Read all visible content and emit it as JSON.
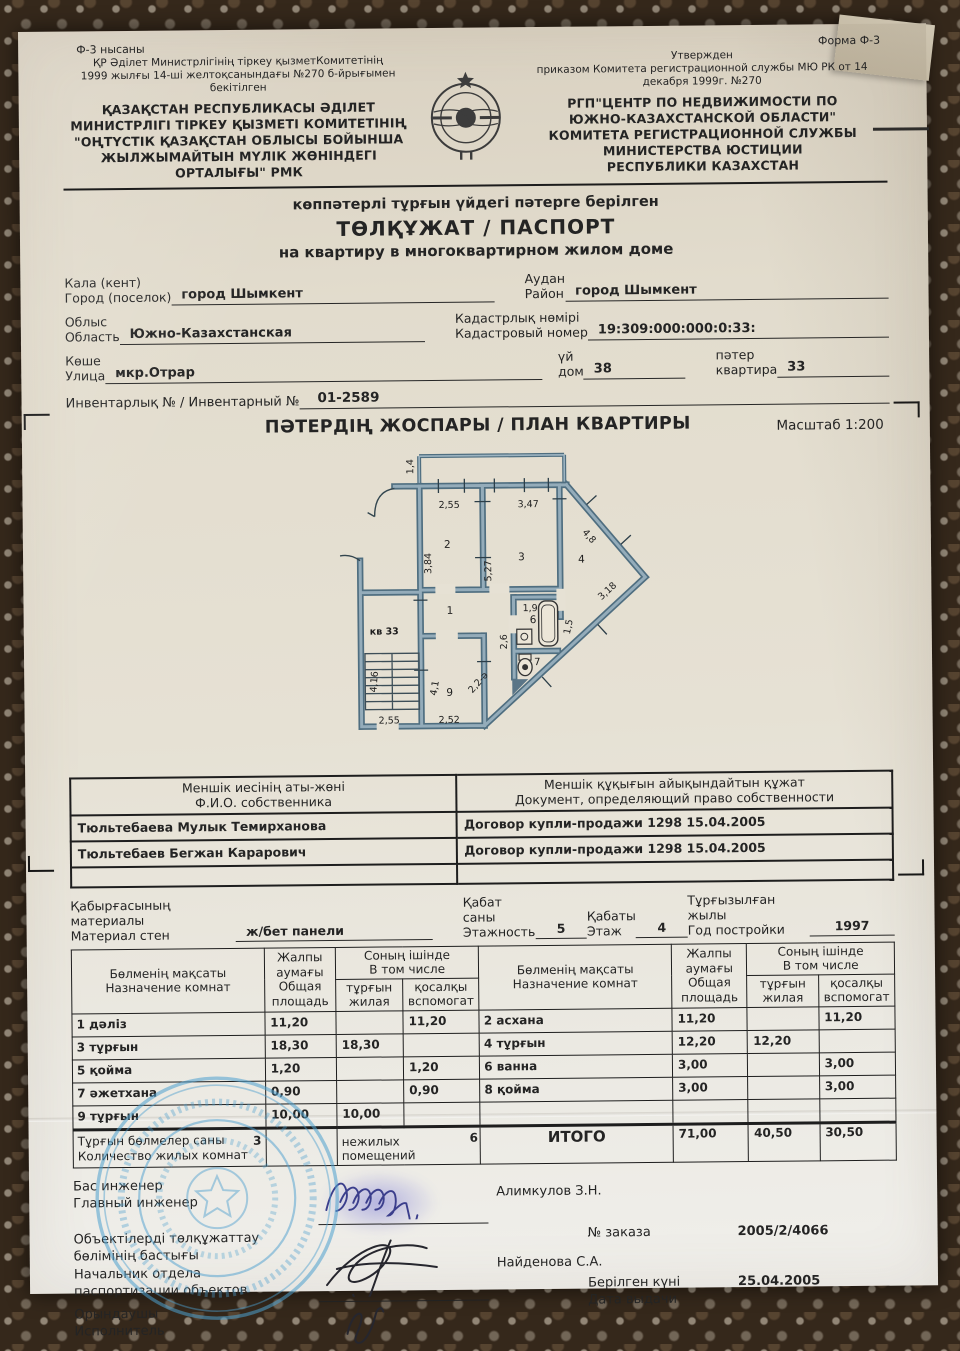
{
  "colors": {
    "paper": "#e6e1d4",
    "ink": "#242424",
    "wall_dark": "#4f6e80",
    "wall_light": "#94acba",
    "stamp_blue": "#4d9fce"
  },
  "header": {
    "form_kz": "Ф-3 нысаны",
    "form_ru": "Форма Ф-3",
    "approved_kz": [
      "ҚР Әділет Министрлігінің тіркеу қызметКомитетінің",
      "1999 жылғы 14-ші желтоқсанындағы №270 б-йрығымен",
      "бекітілген"
    ],
    "org_kz": [
      "ҚАЗАҚСТАН РЕСПУБЛИКАСЫ ӘДІЛЕТ",
      "МИНИСТРЛІГІ ТІРКЕУ ҚЫЗМЕТІ КОМИТЕТІНІҢ",
      "\"ОҢТҮСТІК ҚАЗАҚСТАН ОБЛЫСЫ БОЙЫНША",
      "ЖЫЛЖЫМАЙТЫН МҮЛІК ЖӨНІНДЕГІ",
      "ОРТАЛЫҒЫ\" РМК"
    ],
    "approved_ru": [
      "Утвержден",
      "приказом Комитета регистрационной службы МЮ РК от 14",
      "декабря 1999г.  №270"
    ],
    "org_ru": [
      "РГП\"ЦЕНТР ПО НЕДВИЖИМОСТИ ПО",
      "ЮЖНО-КАЗАХСТАНСКОЙ ОБЛАСТИ\"",
      "КОМИТЕТА РЕГИСТРАЦИОННОЙ СЛУЖБЫ",
      "МИНИСТЕРСТВА ЮСТИЦИИ",
      "РЕСПУБЛИКИ КАЗАХСТАН"
    ]
  },
  "title": {
    "line1": "көппәтерлі тұрғын үйдегі пәтерге берілген",
    "line2": "ТӨЛҚҰЖАТ / ПАСПОРТ",
    "line3": "на квартиру в многоквартирном жилом доме"
  },
  "fields": {
    "city_kz": "Кала (кент)",
    "city_ru": "Город (поселок)",
    "city_value": "город Шымкент",
    "district_kz": "Аудан",
    "district_ru": "Район",
    "district_value": "город Шымкент",
    "oblast_kz": "Облыс",
    "oblast_ru": "Область",
    "oblast_value": "Южно-Казахстанская",
    "cadastre_kz": "Кадастрлық нөмірі",
    "cadastre_ru": "Кадастровый номер",
    "cadastre_value": "19:309:000:000:0:33:",
    "street_kz": "Көше",
    "street_ru": "Улица",
    "street_value": "мкр.Отрар",
    "house_kz": "үй",
    "house_ru": "дом",
    "house_value": "38",
    "apt_kz": "пәтер",
    "apt_ru": "квартира",
    "apt_value": "33",
    "inventory_label": "Инвентарлық № / Инвентарный №",
    "inventory_value": "01-2589"
  },
  "plan": {
    "heading": "ПӘТЕРДІҢ ЖОСПАРЫ / ПЛАН КВАРТИРЫ",
    "scale": "Масштаб 1:200",
    "dims": [
      "1,4",
      "2,55",
      "3,47",
      "2",
      "3",
      "3,84",
      "5,27",
      "4,8",
      "4",
      "3,18",
      "1",
      "кв 33",
      "1,9",
      "6",
      "1,5",
      "2,6",
      "7",
      "4,16",
      "4,1",
      "9",
      "2,2-ә",
      "2,55",
      "2,52"
    ]
  },
  "owners": {
    "col1": [
      "Меншік иесінің аты-жөні",
      "Ф.И.О. собственника"
    ],
    "col2": [
      "Меншік құқығын айықындайтын құжат",
      "Документ, определяющий право собственности"
    ],
    "rows": [
      {
        "name": "Тюльтебаева Мулык Темирханова",
        "doc": "Договор купли-продажи 1298 15.04.2005"
      },
      {
        "name": "Тюльтебаев Бегжан Карарович",
        "doc": "Договор купли-продажи 1298 15.04.2005"
      }
    ]
  },
  "building": {
    "material_kz": "Қабырғасының материалы",
    "material_ru": "Материал стен",
    "material_value": "ж/бет панели",
    "floors_kz": "Қабат саны",
    "floors_ru": "Этажность",
    "floors_value": "5",
    "floor_kz": "Қабаты",
    "floor_ru": "Этаж",
    "floor_value": "4",
    "year_kz": "Тұрғызылған жылы",
    "year_ru": "Год постройки",
    "year_value": "1997"
  },
  "rooms": {
    "purpose": [
      "Бөлменің мақсаты",
      "Назначение комнат"
    ],
    "total": [
      "Жалпы",
      "аумағы",
      "Общая",
      "площадь"
    ],
    "incl": [
      "Соның ішінде",
      "В том числе"
    ],
    "living": [
      "тұрғын",
      "жилая"
    ],
    "aux": [
      "қосалқы",
      "вспомогат"
    ],
    "left_rows": [
      [
        "1 дәліз",
        "11,20",
        "",
        "11,20"
      ],
      [
        "3 тұрғын",
        "18,30",
        "18,30",
        ""
      ],
      [
        "5 қойма",
        "1,20",
        "",
        "1,20"
      ],
      [
        "7 әжетхана",
        "0,90",
        "",
        "0,90"
      ],
      [
        "9 тұрғын",
        "10,00",
        "10,00",
        ""
      ]
    ],
    "right_rows": [
      [
        "2 асхана",
        "11,20",
        "",
        "11,20"
      ],
      [
        "4 тұрғын",
        "12,20",
        "12,20",
        ""
      ],
      [
        "6 ванна",
        "3,00",
        "",
        "3,00"
      ],
      [
        "8 қойма",
        "3,00",
        "",
        "3,00"
      ],
      [
        "",
        "",
        "",
        ""
      ]
    ],
    "totals": {
      "label_kz": "Тұрғын бөлмелер саны",
      "label_ru": "Количество жилых комнат",
      "living_count": "3",
      "nonliving_label": "нежилых помещений",
      "nonliving_count": "6",
      "itogo": "ИТОГО",
      "total": "71,00",
      "living": "40,50",
      "aux": "30,50"
    }
  },
  "signatures": {
    "chief_kz": "Бас инженер",
    "chief_ru": "Главный инженер",
    "chief_name": "Алимкулов З.Н.",
    "dept": [
      "Объектілерді  төлқұжаттау",
      "бөлімінің бастығы",
      "Начальник отдела",
      "паспортизации объектов"
    ],
    "dept_name": "Найденова С.А.",
    "executor_kz": "Орындаушы",
    "executor_ru": "Исполнитель",
    "order_label": "№ заказа",
    "order_value": "2005/2/4066",
    "issued_kz": "Берілген күні",
    "issued_ru": "Дата выдачи",
    "issued_value": "25.04.2005"
  }
}
